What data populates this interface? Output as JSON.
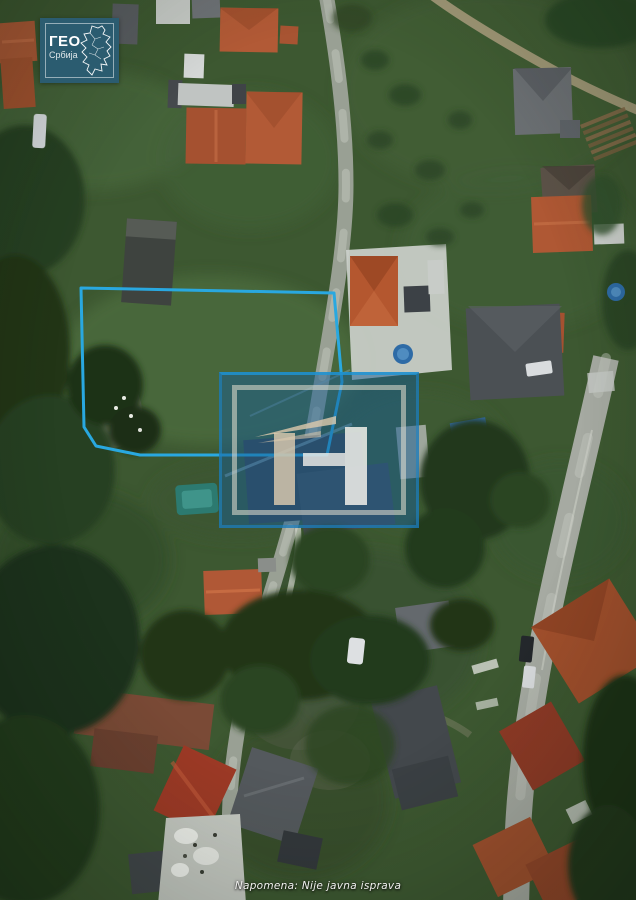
{
  "logo": {
    "title": "ГЕО",
    "subtitle": "Србија"
  },
  "note": {
    "text": "Napomena: Nije javna isprava"
  },
  "parcel": {
    "points": "81,288 334,293 342,382 327,455 140,455 96,446 84,427"
  },
  "colors": {
    "parcel-outline": "#29a8e0",
    "watermark-fill": "rgba(23,94,148,0.5)",
    "watermark-border": "rgba(30,132,198,0.6)",
    "logo-bg": "#2b5c70"
  }
}
